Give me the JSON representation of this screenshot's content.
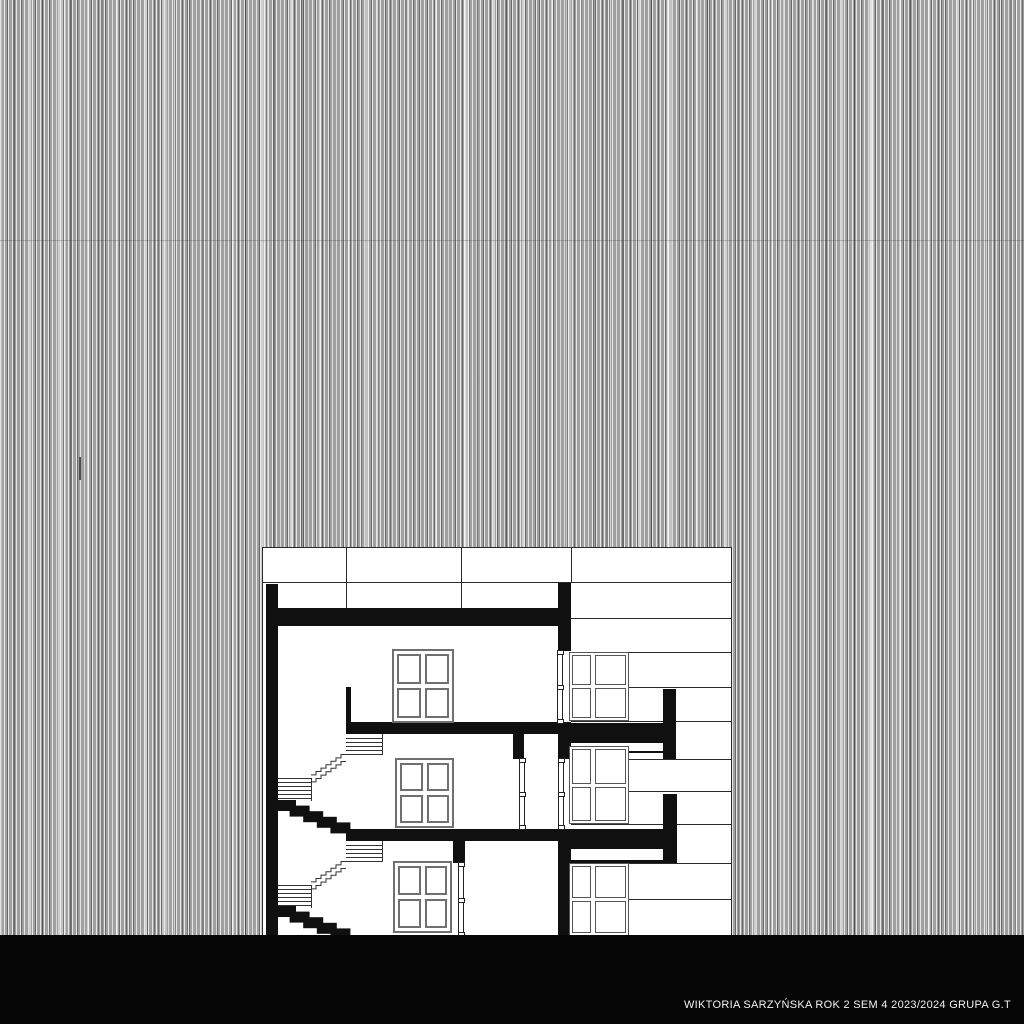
{
  "caption": {
    "text": "WIKTORIA SARZYŃSKA ROK 2 SEM 4 2023/2024 GRUPA G.T"
  },
  "palette": {
    "ink": "#101010",
    "paper": "#ffffff",
    "background_grey": "#a0a0a0",
    "ground_black": "#050505",
    "caption_text": "#f2f2f2",
    "window_frame_grey": "#707070"
  }
}
